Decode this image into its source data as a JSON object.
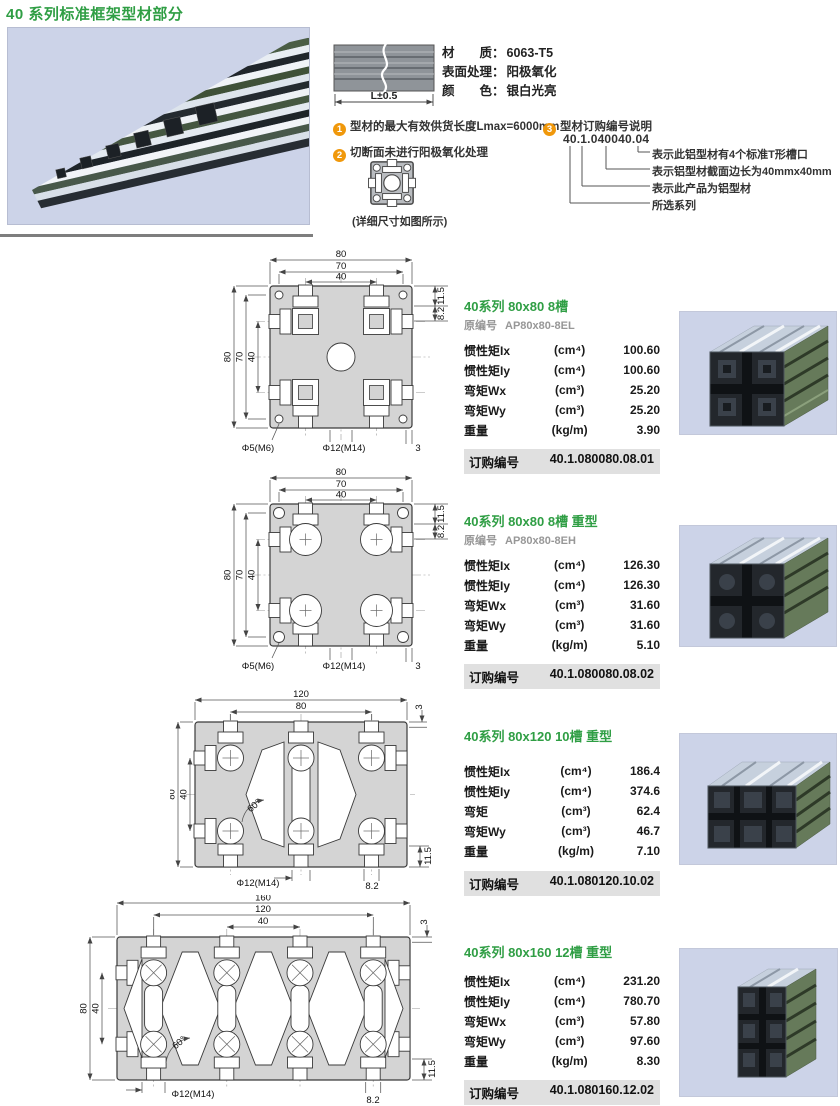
{
  "page": {
    "title": "40 系列标准框架型材部分"
  },
  "header": {
    "length_label": "L±0.5",
    "material_rows": [
      {
        "label": "材　　质：",
        "value": "6063-T5"
      },
      {
        "label": "表面处理：",
        "value": "阳极氧化"
      },
      {
        "label": "颜　　色：",
        "value": "银白光亮"
      }
    ],
    "notes": [
      {
        "num": "1",
        "text": "型材的最大有效供货长度Lmax=6000mm"
      },
      {
        "num": "2",
        "text": "切断面未进行阳极氧化处理"
      },
      {
        "num": "3",
        "text": "型材订购编号说明"
      }
    ],
    "code_example": "40.1.040040.04",
    "code_legend": [
      "表示此铝型材有4个标准T形槽口",
      "表示铝型材截面边长为40mmx40mm",
      "表示此产品为铝型材",
      "所选系列"
    ],
    "detail_caption": "(详细尺寸如图所示)"
  },
  "products": [
    {
      "title": "40系列 80x80 8槽",
      "orig_label": "原编号",
      "orig_code": "AP80x80-8EL",
      "rows": [
        {
          "name": "惯性矩Ix",
          "unit": "(cm⁴)",
          "value": "100.60"
        },
        {
          "name": "惯性矩Iy",
          "unit": "(cm⁴)",
          "value": "100.60"
        },
        {
          "name": "弯矩Wx",
          "unit": "(cm³)",
          "value": "25.20"
        },
        {
          "name": "弯矩Wy",
          "unit": "(cm³)",
          "value": "25.20"
        },
        {
          "name": "重量",
          "unit": "(kg/m)",
          "value": "3.90"
        }
      ],
      "order_label": "订购编号",
      "order_code": "40.1.080080.08.01",
      "drawing": {
        "top1": "80",
        "top2": "70",
        "top3": "40",
        "left1": "80",
        "left2": "70",
        "left3": "40",
        "right1": "11.5",
        "right2": "8.2",
        "hole1": "Φ5(M6)",
        "hole2": "Φ12(M14)",
        "wall": "3"
      }
    },
    {
      "title": "40系列 80x80 8槽 重型",
      "orig_label": "原编号",
      "orig_code": "AP80x80-8EH",
      "rows": [
        {
          "name": "惯性矩Ix",
          "unit": "(cm⁴)",
          "value": "126.30"
        },
        {
          "name": "惯性矩Iy",
          "unit": "(cm⁴)",
          "value": "126.30"
        },
        {
          "name": "弯矩Wx",
          "unit": "(cm³)",
          "value": "31.60"
        },
        {
          "name": "弯矩Wy",
          "unit": "(cm³)",
          "value": "31.60"
        },
        {
          "name": "重量",
          "unit": "(kg/m)",
          "value": "5.10"
        }
      ],
      "order_label": "订购编号",
      "order_code": "40.1.080080.08.02",
      "drawing": {
        "top1": "80",
        "top2": "70",
        "top3": "40",
        "left1": "80",
        "left2": "70",
        "left3": "40",
        "right1": "11.5",
        "right2": "8.2",
        "hole1": "Φ5(M6)",
        "hole2": "Φ12(M14)",
        "wall": "3"
      }
    },
    {
      "title": "40系列 80x120 10槽 重型",
      "rows": [
        {
          "name": "惯性矩Ix",
          "unit": "(cm⁴)",
          "value": "186.4"
        },
        {
          "name": "惯性矩Iy",
          "unit": "(cm⁴)",
          "value": "374.6"
        },
        {
          "name": "弯矩",
          "unit": "(cm³)",
          "value": "62.4"
        },
        {
          "name": "弯矩Wy",
          "unit": "(cm³)",
          "value": "46.7"
        },
        {
          "name": "重量",
          "unit": "(kg/m)",
          "value": "7.10"
        }
      ],
      "order_label": "订购编号",
      "order_code": "40.1.080120.10.02",
      "drawing": {
        "top1": "120",
        "top2": "80",
        "left1": "80",
        "left2": "40",
        "angle": "60°",
        "hole": "Φ12(M14)",
        "b115": "11.5",
        "b82": "8.2",
        "wall": "3"
      }
    },
    {
      "title": "40系列 80x160 12槽 重型",
      "rows": [
        {
          "name": "惯性矩Ix",
          "unit": "(cm⁴)",
          "value": "231.20"
        },
        {
          "name": "惯性矩Iy",
          "unit": "(cm⁴)",
          "value": "780.70"
        },
        {
          "name": "弯矩Wx",
          "unit": "(cm³)",
          "value": "57.80"
        },
        {
          "name": "弯矩Wy",
          "unit": "(cm³)",
          "value": "97.60"
        },
        {
          "name": "重量",
          "unit": "(kg/m)",
          "value": "8.30"
        }
      ],
      "order_label": "订购编号",
      "order_code": "40.1.080160.12.02",
      "drawing": {
        "top1": "160",
        "top2": "120",
        "top3": "40",
        "left1": "80",
        "left2": "40",
        "angle": "60°",
        "hole": "Φ12(M14)",
        "b82": "8.2",
        "b115": "11.5",
        "wall": "3"
      }
    }
  ]
}
